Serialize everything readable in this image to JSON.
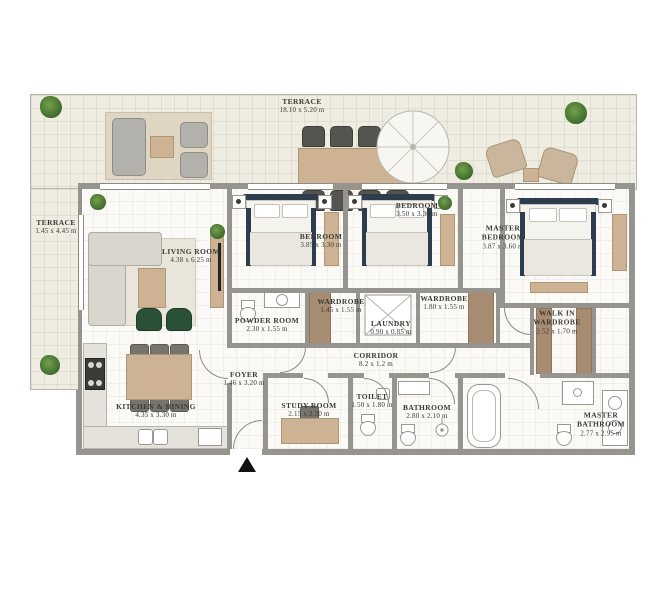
{
  "plan": {
    "rooms": {
      "terrace_main": {
        "label": "TERRACE",
        "dims": "18.10 x 5.20 m"
      },
      "terrace_side": {
        "label": "TERRACE",
        "dims": "1.45 x 4.45 m"
      },
      "living_room": {
        "label": "LIVING ROOM",
        "dims": "4.38 x 6.25 m"
      },
      "bedroom_1": {
        "label": "BEDROOM",
        "dims": "3.85 x 3.30 m"
      },
      "bedroom_2": {
        "label": "BEDROOM",
        "dims": "3.50 x 3.30 m"
      },
      "master_bedroom": {
        "label": "MASTER BEDROOM",
        "dims": "3.87 x 3.60 m"
      },
      "powder_room": {
        "label": "POWDER ROOM",
        "dims": "2.30 x 1.55 m"
      },
      "wardrobe_1": {
        "label": "WARDROBE",
        "dims": "1.45 x 1.55 m"
      },
      "laundry": {
        "label": "LAUNDRY",
        "dims": "0.90 x 0.85 m"
      },
      "wardrobe_2": {
        "label": "WARDROBE",
        "dims": "1.80 x 1.55 m"
      },
      "walk_in_wardrobe": {
        "label": "WALK IN WARDROBE",
        "dims": "2.52 x 1.70 m"
      },
      "corridor": {
        "label": "CORRIDOR",
        "dims": "8.2 x 1.2 m"
      },
      "foyer": {
        "label": "FOYER",
        "dims": "1.46 x 3.20 m"
      },
      "kitchen_dining": {
        "label": "KITCHEN & DINING",
        "dims": "4.35 x 3.30 m"
      },
      "study_room": {
        "label": "STUDY ROOM",
        "dims": "2.15 x 2.30 m"
      },
      "toilet": {
        "label": "TOILET",
        "dims": "1.50 x 1.80 m"
      },
      "bathroom": {
        "label": "BATHROOM",
        "dims": "2.80 x 2.10 m"
      },
      "master_bathroom": {
        "label": "MASTER BATHROOM",
        "dims": "2.77 x 2.95 m"
      }
    },
    "colors": {
      "terrace_floor": "#efece1",
      "room_floor": "#fbfaf6",
      "wall": "#96948e",
      "wardrobe_wood": "#a78c71",
      "furniture_wood": "#cdb394",
      "bed_accent": "#2e3d4d",
      "plant_green": "#3d6a2c",
      "text": "#3b3a36"
    }
  }
}
